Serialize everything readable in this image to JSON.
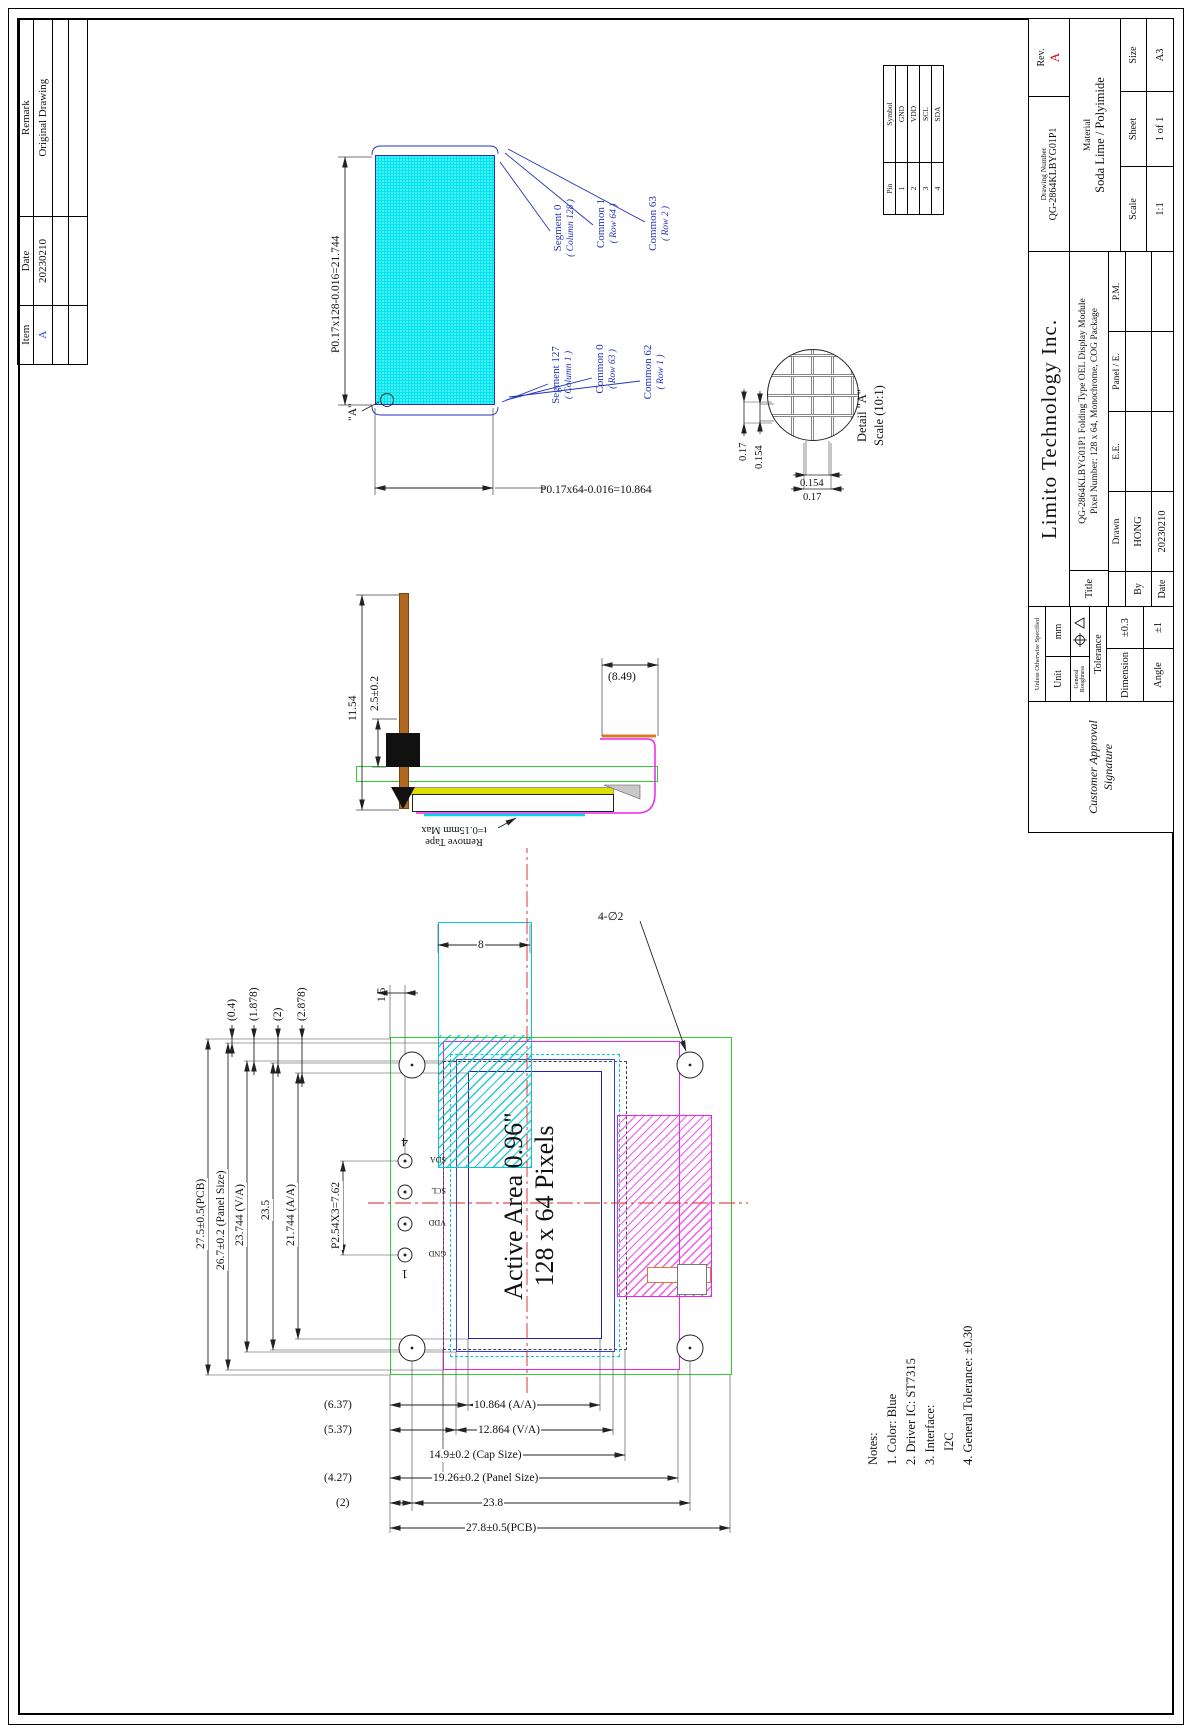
{
  "colors": {
    "display_fill": "#00e6f0",
    "outline_green": "#33cc33",
    "outline_magenta": "#ee22ee",
    "outline_blue": "#2233cc",
    "centerline_red": "#dd2222",
    "annotation_blue": "#2233bb",
    "pin_orange": "#b06820",
    "layer_yellow": "#e0e000",
    "rev_red": "#cc1111"
  },
  "revision_table": {
    "headers": [
      "Item",
      "Date",
      "Remark"
    ],
    "row": [
      "A",
      "20230210",
      "Original Drawing"
    ]
  },
  "pin_table": {
    "col_pin": "Pin",
    "col_symbol": "Symbol",
    "rows": [
      [
        "1",
        "GND"
      ],
      [
        "2",
        "VDD"
      ],
      [
        "3",
        "SCL"
      ],
      [
        "4",
        "SDA"
      ]
    ]
  },
  "pixel_view": {
    "dim_width": "P0.17x128-0.016=21.744",
    "dim_height": "P0.17x64-0.016=10.864",
    "detail_ref": "\"A\"",
    "labels": [
      {
        "name": "Segment 127",
        "sub": "( Column 1 )"
      },
      {
        "name": "Common 0",
        "sub": "( Row 63 )"
      },
      {
        "name": "Common 62",
        "sub": "( Row 1 )"
      },
      {
        "name": "Segment 0",
        "sub": "( Column 128 )"
      },
      {
        "name": "Common 1",
        "sub": "( Row 64 )"
      },
      {
        "name": "Common 63",
        "sub": "( Row 2 )"
      }
    ]
  },
  "detail_a": {
    "dim_h1": "0.17",
    "dim_h2": "0.154",
    "dim_v1": "0.154",
    "dim_v2": "0.17",
    "title": "Detail \"A\"",
    "scale": "Scale (10:1)"
  },
  "side_view": {
    "dim_total": "11.54",
    "dim_header": "2.5±0.2",
    "dim_fpc": "(8.49)",
    "tape_note_1": "Remove Tape",
    "tape_note_2": "t=0.15mm Max"
  },
  "main_view": {
    "dim_pcb_w": "27.5±0.5(PCB)",
    "dim_panel_w": "26.7±0.2 (Panel Size)",
    "dim_va_w": "23.744 (V/A)",
    "dim_cap_w": "23.5",
    "dim_aa_w": "21.744 (A/A)",
    "dim_pitch": "P2.54X3=7.62",
    "off1": "(0.4)",
    "off2": "(1.878)",
    "off3": "(2)",
    "off4": "(2.878)",
    "dim_pin_edge": "1.5",
    "dim_fold": "8",
    "holes_label": "4-∅2",
    "pin_num_first": "1",
    "pin_num_last": "4",
    "pin_names": [
      "GND",
      "VDD",
      "SCL",
      "SDA"
    ],
    "active_1": "Active Area 0.96\"",
    "active_2": "128 x 64 Pixels",
    "dim_aa_off": "(6.37)",
    "dim_aa_h": "10.864 (A/A)",
    "dim_va_off": "(5.37)",
    "dim_va_h": "12.864 (V/A)",
    "dim_cap_h": "14.9±0.2 (Cap Size)",
    "dim_panel_off": "(4.27)",
    "dim_panel_h": "19.26±0.2 (Panel Size)",
    "dim_hole_off": "(2)",
    "dim_hole_pitch": "23.8",
    "dim_pcb_h": "27.8±0.5(PCB)"
  },
  "notes": {
    "title": "Notes:",
    "items": [
      "1. Color: Blue",
      "2. Driver IC: ST7315",
      "3. Interface:",
      "I2C",
      "4. General Tolerance: ±0.30"
    ]
  },
  "title_block": {
    "customer_approval_1": "Customer Approval",
    "customer_approval_2": "Signature",
    "unless": "Unless Otherwise Specified",
    "unit_label": "Unit",
    "unit_value": "mm",
    "roughness_label": "General Roughness",
    "tolerance_label": "Tolerance",
    "dimension_label": "Dimension",
    "dimension_value": "±0.3",
    "angle_label": "Angle",
    "angle_value": "±1",
    "company": "Limito Technology Inc.",
    "title_label": "Title",
    "title_line1": "QG-2864KLBYG01P1 Folding Type OEL Display Module",
    "title_line2": "Pixel Number: 128 x 64, Monochrome, COG Package",
    "by_label": "By",
    "date_label": "Date",
    "drawn_label": "Drawn",
    "drawn_value": "HONG",
    "date_value": "20230210",
    "ee_label": "E.E.",
    "panel_label": "Panel / E.",
    "pm_label": "P.M.",
    "drawing_number_label": "Drawing Number",
    "drawing_number": "QG-2864KLBYG01P1",
    "rev_label": "Rev.",
    "rev_value": "A",
    "material_label": "Material",
    "material_value": "Soda Lime / Polyimide",
    "scale_label": "Scale",
    "scale_value": "1:1",
    "sheet_label": "Sheet",
    "sheet_value": "1 of 1",
    "size_label": "Size",
    "size_value": "A3"
  }
}
